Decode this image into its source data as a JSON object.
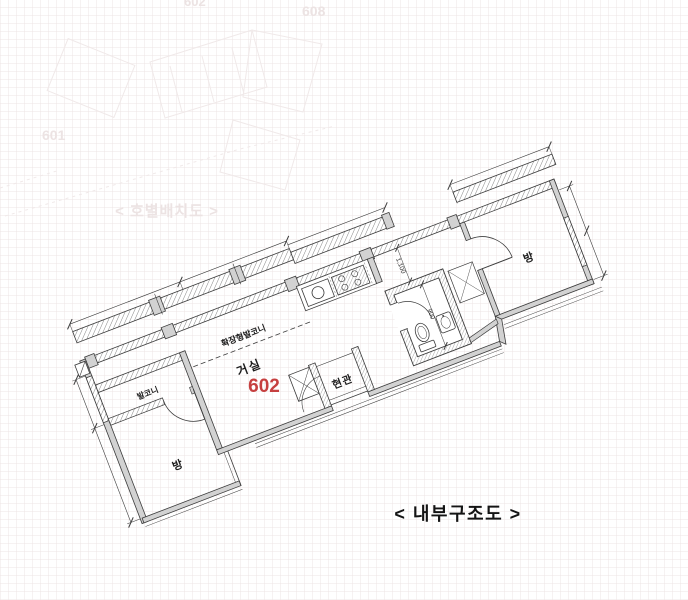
{
  "caption": "< 내부구조도 >",
  "unit": {
    "number": "602"
  },
  "rooms": {
    "living": "거실",
    "extended_balcony": "확장형발코니",
    "balcony": "발코니",
    "bedroom_left": "방",
    "bedroom_right": "방",
    "entrance": "현관"
  },
  "dimensions": {
    "hall": "1,100",
    "bath": "900"
  },
  "ghost": {
    "caption": "< 호별배치도 >",
    "unit_601": "601",
    "unit_602": "602",
    "unit_608": "608"
  },
  "colors": {
    "line": "#3c3c3c",
    "wall_fill": "#d2d2d2",
    "unit_number_red": "#c64040",
    "ghost_text": "#ece3e3",
    "caption_black": "#141414"
  }
}
